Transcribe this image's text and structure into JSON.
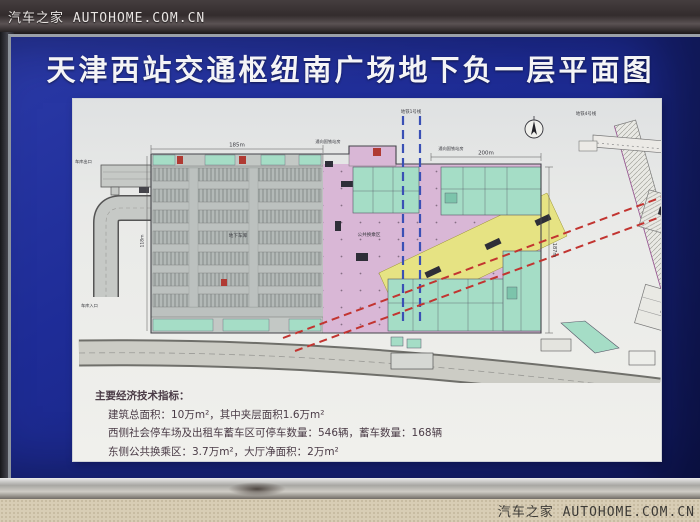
{
  "watermarks": {
    "top_left": "汽车之家  AUTOHOME.COM.CN",
    "bottom_right": "汽车之家  AUTOHOME.COM.CN"
  },
  "board": {
    "title": "天津西站交通枢纽南广场地下负一层平面图"
  },
  "plan": {
    "dimensions": {
      "top_left": "185m",
      "top_right": "200m",
      "right": "187m",
      "left": "118m"
    },
    "labels": {
      "garage": "地下车库",
      "transfer_hall": "公共换乘区",
      "garage_exit": "车库出口",
      "garage_entrance": "车库入口",
      "metro_line1": "地铁1号线",
      "metro_line4": "地铁4号线",
      "to_rail_station_1": "通向国铁站房",
      "to_rail_station_2": "通向国铁站房"
    },
    "colors": {
      "parking_grey": "#bcc1bf",
      "hall_pink": "#d9b7d6",
      "rooms_mint": "#a5ddc6",
      "metro_corridor_yellow": "#e6e383",
      "metro_dashed_red": "#c23430",
      "metro_dashed_blue": "#3a50b5",
      "board_blue": "#1e2c97"
    }
  },
  "indicators": {
    "heading": "主要经济技术指标：",
    "lines": [
      "建筑总面积：10万m²，其中夹层面积1.6万m²",
      "西侧社会停车场及出租车蓄车区可停车数量：546辆，蓄车数量：168辆",
      "东侧公共换乘区：3.7万m²，大厅净面积：2万m²"
    ]
  }
}
